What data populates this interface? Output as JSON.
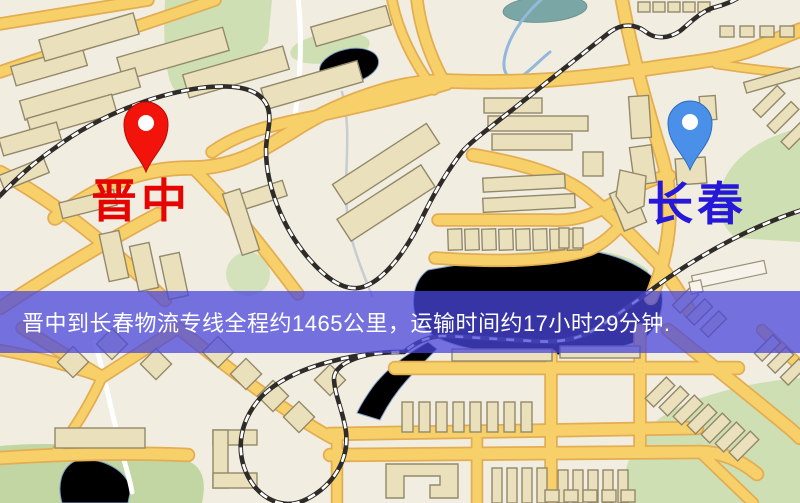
{
  "page": {
    "width": 800,
    "height": 503
  },
  "banner": {
    "text": "晋中到长春物流专线全程约1465公里，运输时间约17小时29分钟.",
    "background": "rgba(73,71,221,0.75)",
    "text_color": "#ffffff"
  },
  "markers": {
    "origin": {
      "label": "晋中",
      "pin_color": "#f2130a",
      "pin_stroke": "#b50d05",
      "label_color": "#e60400"
    },
    "destination": {
      "label": "长春",
      "pin_color": "#4a90e8",
      "pin_stroke": "#2f6fc0",
      "label_color": "#2618d8"
    }
  },
  "map_palette": {
    "background": "#f2ede1",
    "road_fill": "#f7d06a",
    "road_casing": "#e3ad52",
    "building_fill": "#eae0bc",
    "building_stroke": "#93896a",
    "park_green": "#cfdfb4",
    "park_green_dark": "#c2d6a4",
    "water_blue": "#85aede",
    "railway_dark": "#2e2b28"
  }
}
